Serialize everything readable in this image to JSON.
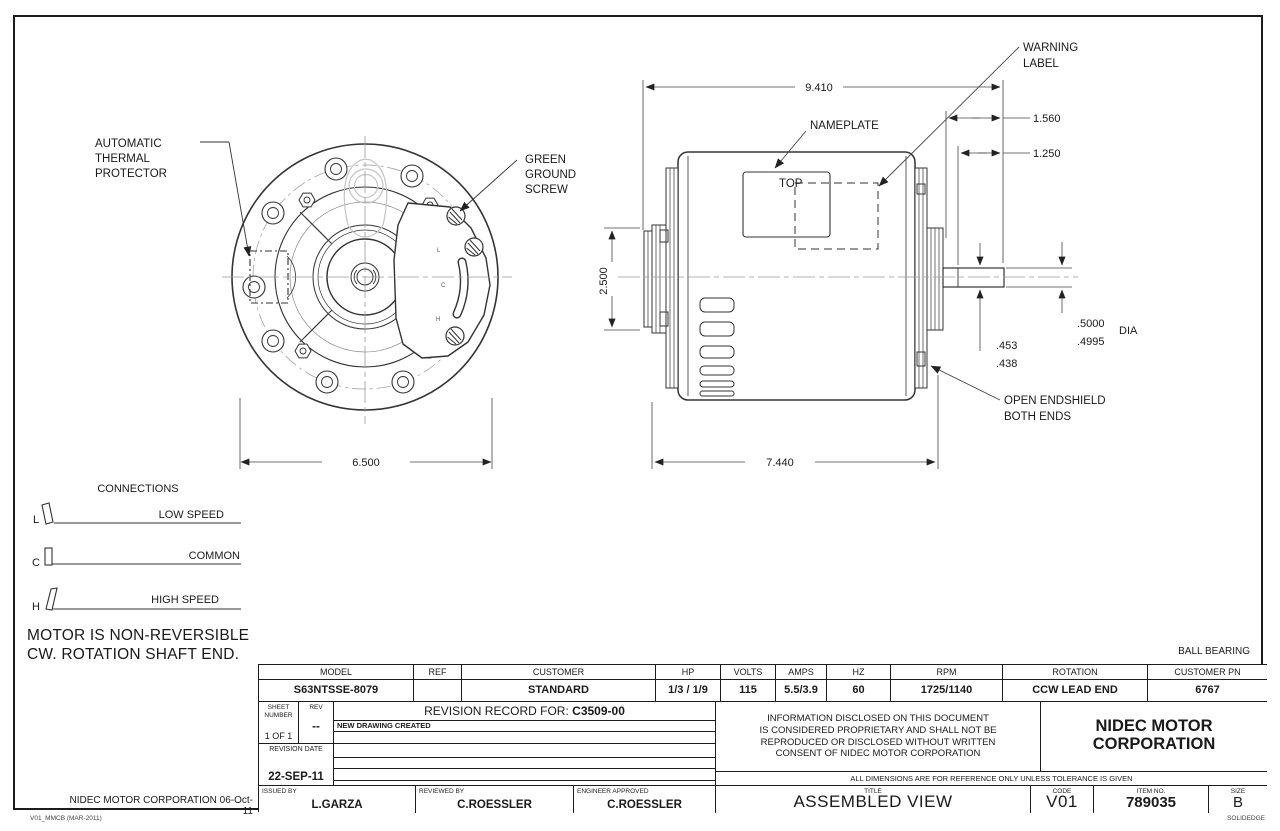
{
  "front_view": {
    "thermal_label": [
      "AUTOMATIC",
      "THERMAL",
      "PROTECTOR"
    ],
    "ground_label": [
      "GREEN",
      "GROUND",
      "SCREW"
    ],
    "terminals": [
      "L",
      "C",
      "H"
    ],
    "dim_width": "6.500"
  },
  "side_view": {
    "labels": {
      "warning1": "WARNING",
      "warning2": "LABEL",
      "nameplate": "NAMEPLATE",
      "top": "TOP",
      "endshield1": "OPEN ENDSHIELD",
      "endshield2": "BOTH ENDS"
    },
    "dims": {
      "overall": "9.410",
      "d1560": "1.560",
      "d1250": "1.250",
      "height": "2.500",
      "body": "7.440",
      "dia_hi": ".5000",
      "dia_lo": ".4995",
      "dia_txt": "DIA",
      "flat_hi": ".453",
      "flat_lo": ".438"
    }
  },
  "connections": {
    "title": "CONNECTIONS",
    "rows": [
      {
        "letter": "L",
        "label": "LOW SPEED"
      },
      {
        "letter": "C",
        "label": "COMMON"
      },
      {
        "letter": "H",
        "label": "HIGH SPEED"
      }
    ],
    "note1": "MOTOR IS NON-REVERSIBLE",
    "note2": "CW. ROTATION SHAFT END."
  },
  "notes": {
    "bearing": "BALL BEARING"
  },
  "title_block": {
    "spec_headers": [
      "MODEL",
      "REF",
      "CUSTOMER",
      "HP",
      "VOLTS",
      "AMPS",
      "HZ",
      "RPM",
      "ROTATION",
      "CUSTOMER PN"
    ],
    "spec_values": [
      "S63NTSSE-8079",
      "",
      "STANDARD",
      "1/3 / 1/9",
      "115",
      "5.5/3.9",
      "60",
      "1725/1140",
      "CCW LEAD END",
      "6767"
    ],
    "sheet_label1": "SHEET",
    "sheet_label2": "NUMBER",
    "sheet_value": "1 OF 1",
    "rev_label": "REV",
    "rev_value": "--",
    "record_label": "REVISION RECORD FOR:",
    "record_number": "C3509-00",
    "record_note": "NEW DRAWING CREATED",
    "revision_date_label": "REVISION DATE",
    "revision_date_value": "22-SEP-11",
    "proprietary": [
      "INFORMATION DISCLOSED ON THIS DOCUMENT",
      "IS CONSIDERED PROPRIETARY AND SHALL NOT BE",
      "REPRODUCED OR DISCLOSED WITHOUT WRITTEN",
      "CONSENT OF NIDEC MOTOR CORPORATION"
    ],
    "company1": "NIDEC MOTOR",
    "company2": "CORPORATION",
    "tolerance_note": "ALL DIMENSIONS ARE FOR REFERENCE ONLY UNLESS TOLERANCE IS GIVEN",
    "issued_label": "ISSUED BY",
    "issued_value": "L.GARZA",
    "reviewed_label": "REVIEWED BY",
    "reviewed_value": "C.ROESSLER",
    "engineer_label": "ENGINEER APPROVED",
    "engineer_value": "C.ROESSLER",
    "title_label": "TITLE",
    "title_value": "ASSEMBLED VIEW",
    "code_label": "CODE",
    "code_value": "V01",
    "item_label": "ITEM NO.",
    "item_value": "789035",
    "size_label": "SIZE",
    "size_value": "B",
    "footer_left": "NIDEC MOTOR CORPORATION 06-Oct-11"
  },
  "corner": {
    "left": "V01_MMCB (MAR-2011)",
    "right": "SOLIDEDGE"
  }
}
